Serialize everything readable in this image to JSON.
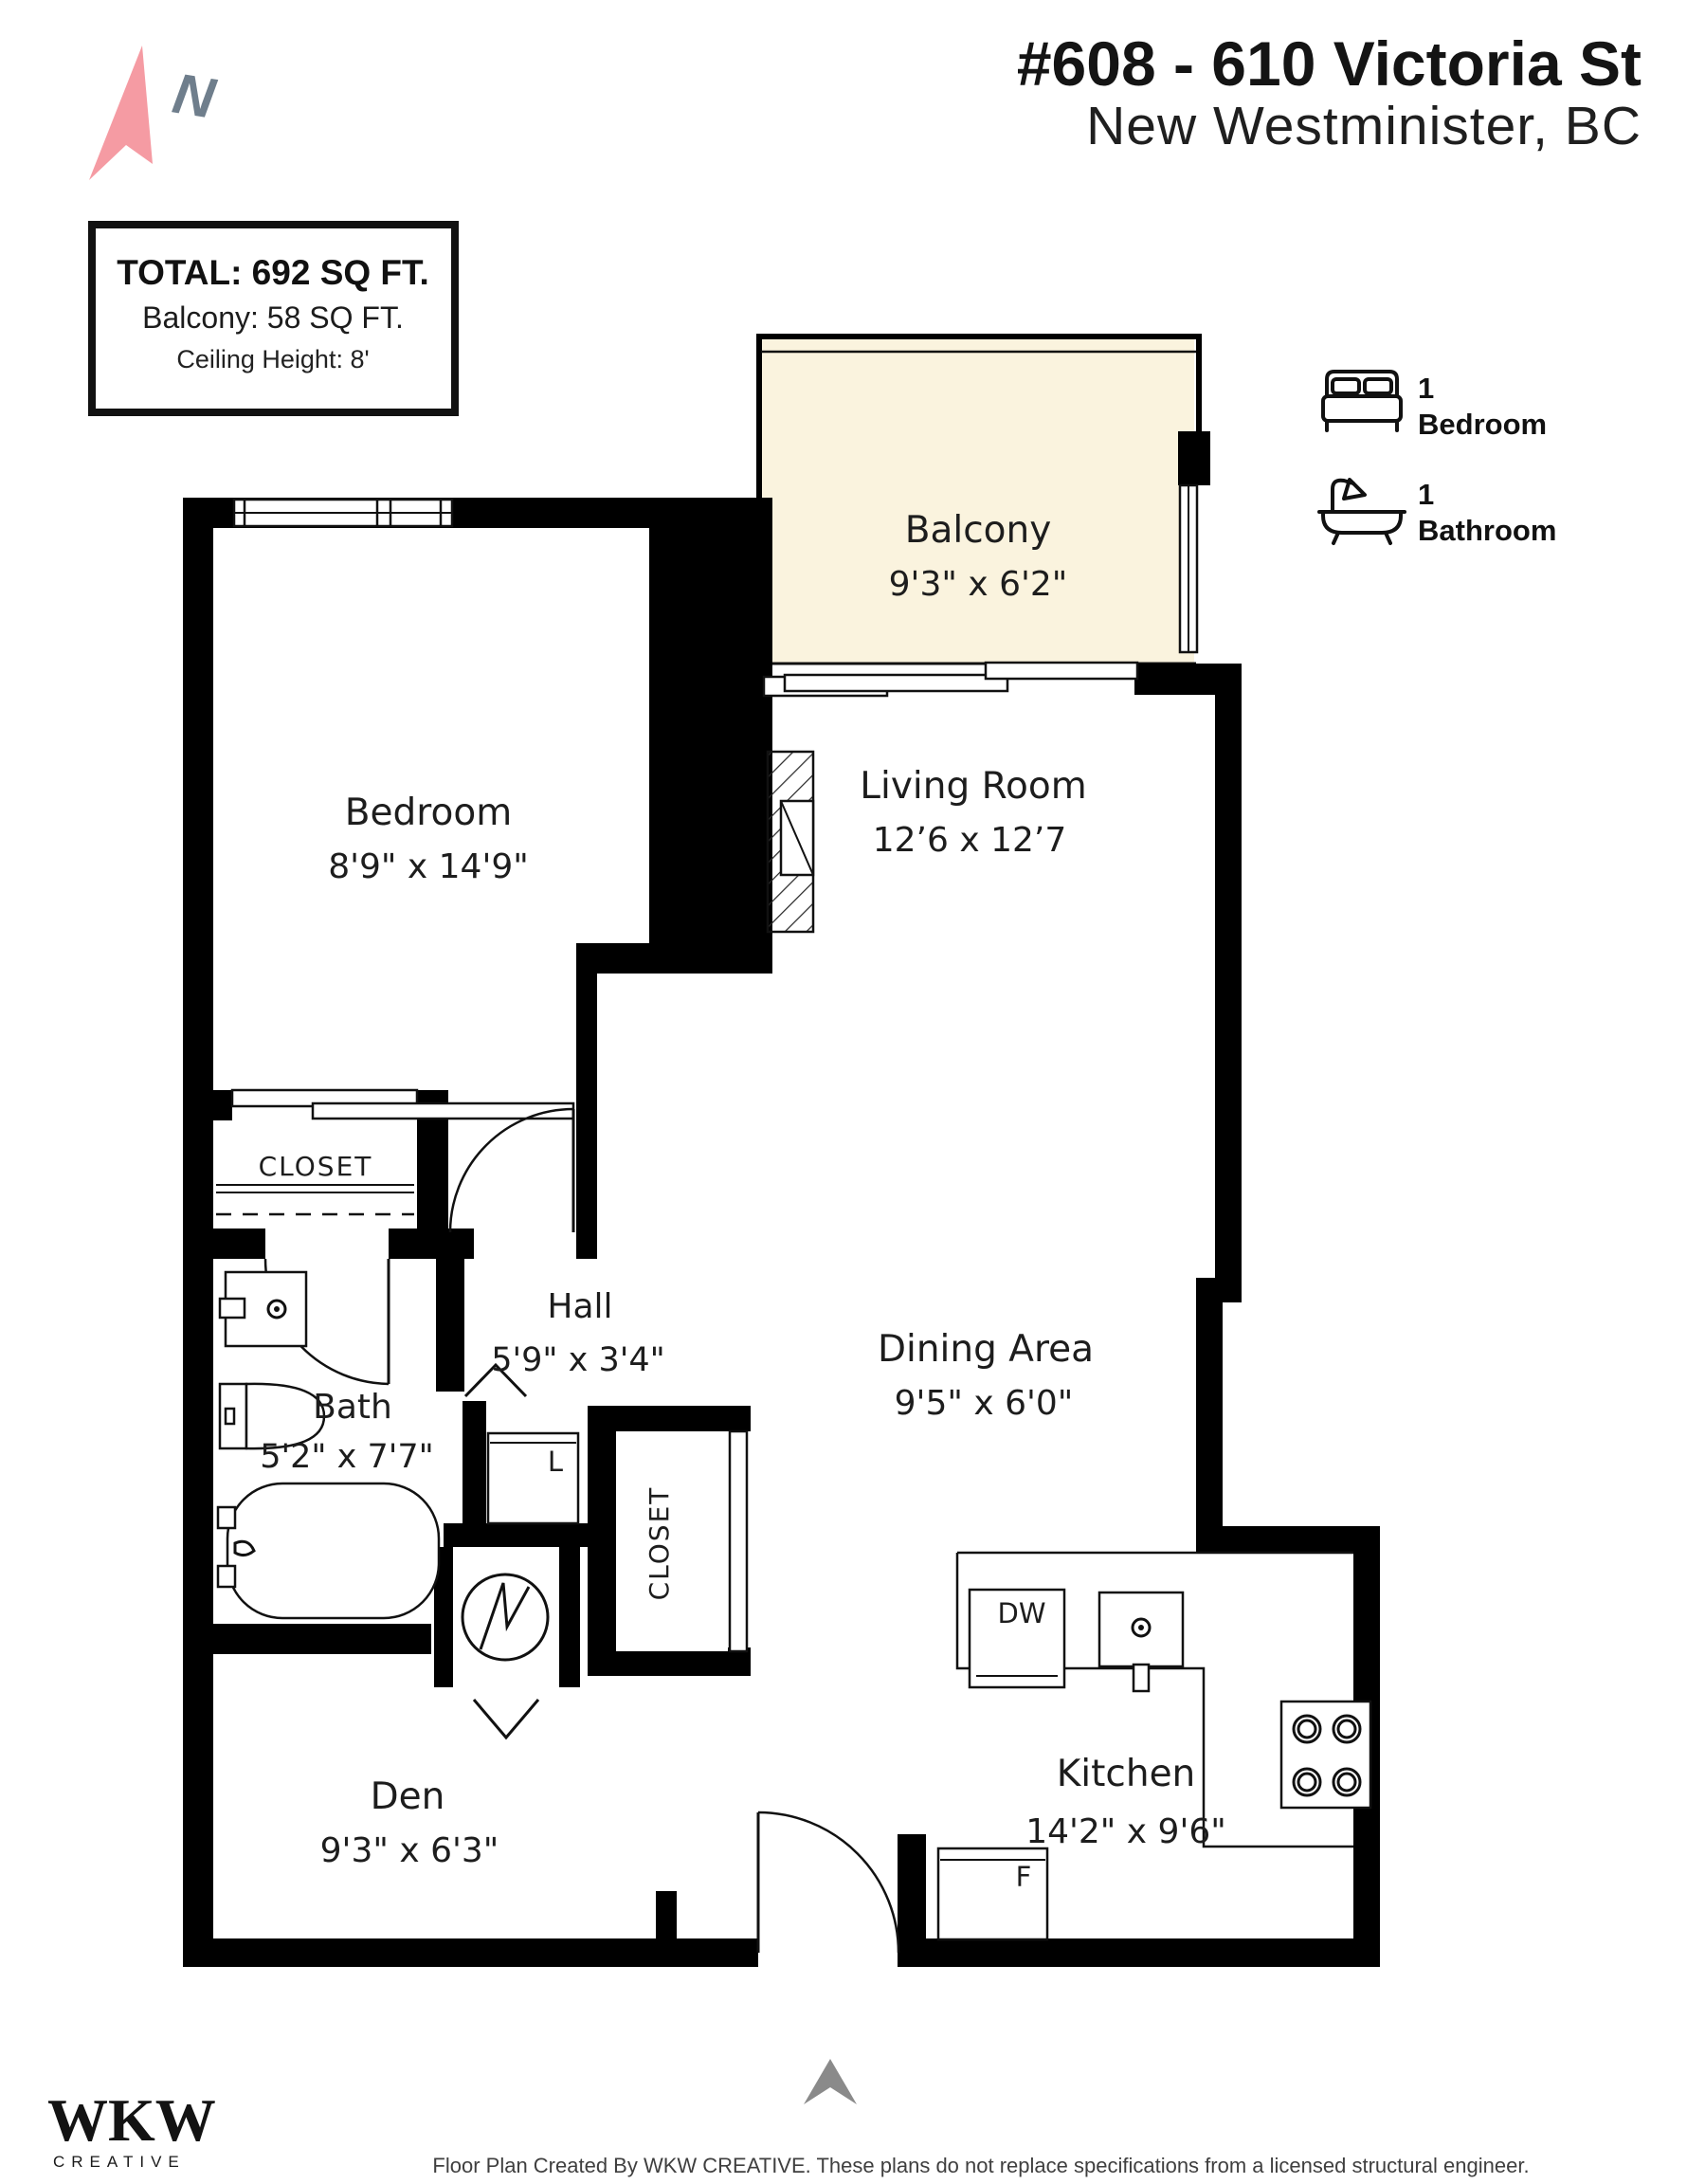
{
  "header": {
    "title": "#608 - 610 Victoria St",
    "subtitle": "New Westminister, BC"
  },
  "compass": {
    "label": "N"
  },
  "info_box": {
    "total": "TOTAL: 692 SQ FT.",
    "balcony": "Balcony: 58 SQ FT.",
    "ceiling": "Ceiling Height: 8'"
  },
  "legend": {
    "bedroom_count": "1",
    "bedroom_label": "Bedroom",
    "bathroom_count": "1",
    "bathroom_label": "Bathroom"
  },
  "rooms": {
    "balcony": {
      "name": "Balcony",
      "dims": "9'3\" x 6'2\""
    },
    "bedroom": {
      "name": "Bedroom",
      "dims": "8'9\" x 14'9\""
    },
    "living": {
      "name": "Living Room",
      "dims": "12’6 x 12’7"
    },
    "dining": {
      "name": "Dining Area",
      "dims": "9'5\" x 6'0\""
    },
    "kitchen": {
      "name": "Kitchen",
      "dims": "14'2\" x 9'6\""
    },
    "den": {
      "name": "Den",
      "dims": "9'3\" x 6'3\""
    },
    "hall": {
      "name": "Hall",
      "dims": "5'9\" x 3'4\""
    },
    "bath": {
      "name": "Bath",
      "dims": "5'2\" x 7'7\""
    }
  },
  "fixtures": {
    "bedroom_closet": "CLOSET",
    "hall_closet": "CLOSET",
    "laundry": "L",
    "dishwasher": "DW",
    "fridge": "F"
  },
  "footer": {
    "logo_main": "WKW",
    "logo_sub": "CREATIVE",
    "disclaimer": "Floor Plan Created By WKW CREATIVE. These plans do not replace specifications from a licensed structural engineer."
  },
  "colors": {
    "accent_pink": "#F59BA3",
    "compass_gray": "#6F7E8C",
    "balcony_fill": "#FAF3DE",
    "wall": "#000000",
    "entry_arrow_gray": "#8A8A8A"
  }
}
